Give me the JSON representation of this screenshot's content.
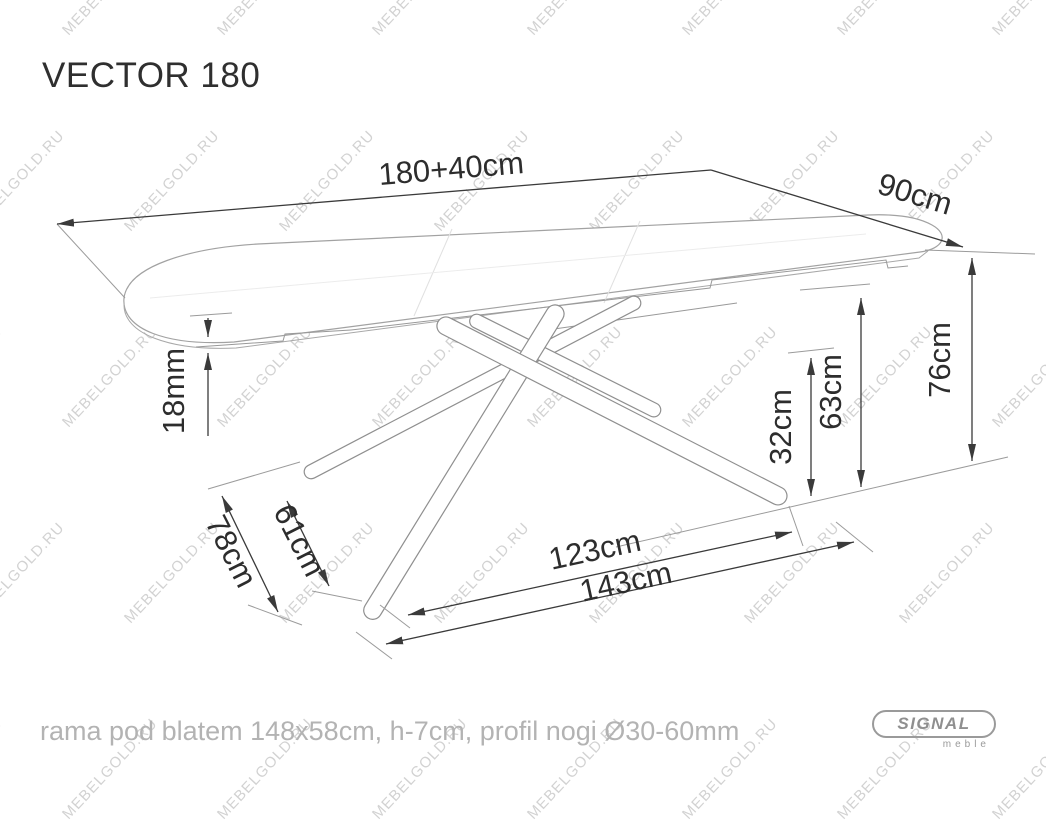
{
  "title": "VECTOR 180",
  "watermark": {
    "text": "MEBELGOLD.RU"
  },
  "footer": {
    "note": "rama pod blatem 148x58cm, h-7cm, profil nogi Ø30-60mm"
  },
  "logo": {
    "brand": "SIGNAL",
    "sub": "meble"
  },
  "dimensions": {
    "top_length": "180+40cm",
    "top_depth": "90cm",
    "height": "76cm",
    "frame_height": "63cm",
    "clearance": "32cm",
    "top_thickness": "18mm",
    "feet_span_inner": "61cm",
    "feet_span_outer": "78cm",
    "base_span_inner": "123cm",
    "base_span_outer": "143cm"
  },
  "colors": {
    "dimension_lines": "#3a3a3a",
    "table_outline": "#a2a2a2",
    "footer_text": "#b3b3b3",
    "watermark": "#d2d2d2",
    "logo": "#9a9a9a",
    "background": "#ffffff"
  }
}
